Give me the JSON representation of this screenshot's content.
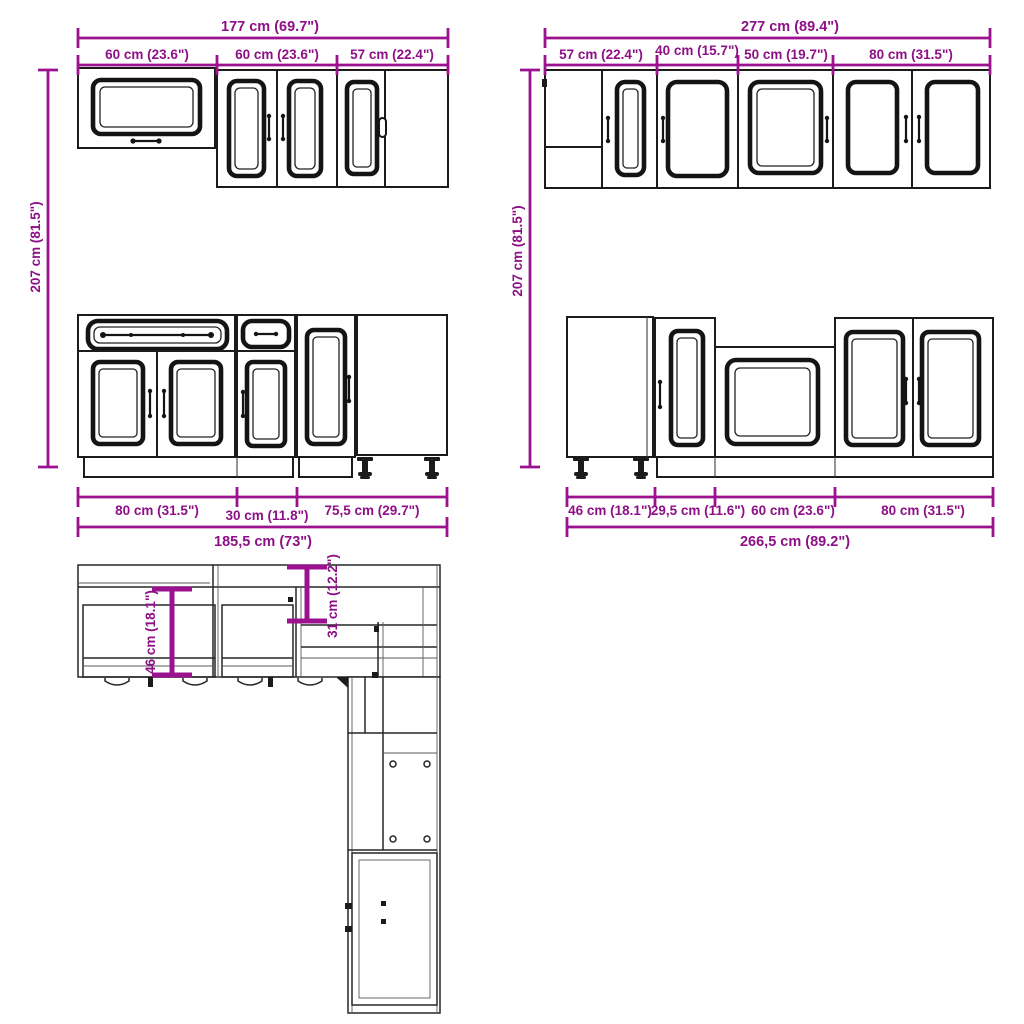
{
  "title": "Kitchen cabinet set dimension diagram",
  "colors": {
    "dimension": "#9b1190",
    "line": "#1b1b1b",
    "background": "#ffffff"
  },
  "wall_left": {
    "total": "177 cm (69.7\")",
    "segments": [
      "60 cm (23.6\")",
      "60 cm (23.6\")",
      "57 cm (22.4\")"
    ],
    "height": "207 cm (81.5\")"
  },
  "wall_right": {
    "total": "277 cm (89.4\")",
    "segments": [
      "57 cm (22.4\")",
      "40 cm (15.7\")",
      "50 cm (19.7\")",
      "80 cm (31.5\")"
    ],
    "height": "207 cm (81.5\")"
  },
  "base_left": {
    "segments": [
      "80 cm (31.5\")",
      "30 cm (11.8\")",
      "75,5 cm (29.7\")"
    ],
    "total": "185,5 cm (73\")"
  },
  "base_right": {
    "segments": [
      "46 cm (18.1\")",
      "29,5 cm (11.6\")",
      "60 cm (23.6\")",
      "80 cm (31.5\")"
    ],
    "total": "266,5 cm (89.2\")"
  },
  "plan": {
    "base_depth": "46 cm (18.1\")",
    "wall_depth": "31 cm (12.2\")"
  }
}
